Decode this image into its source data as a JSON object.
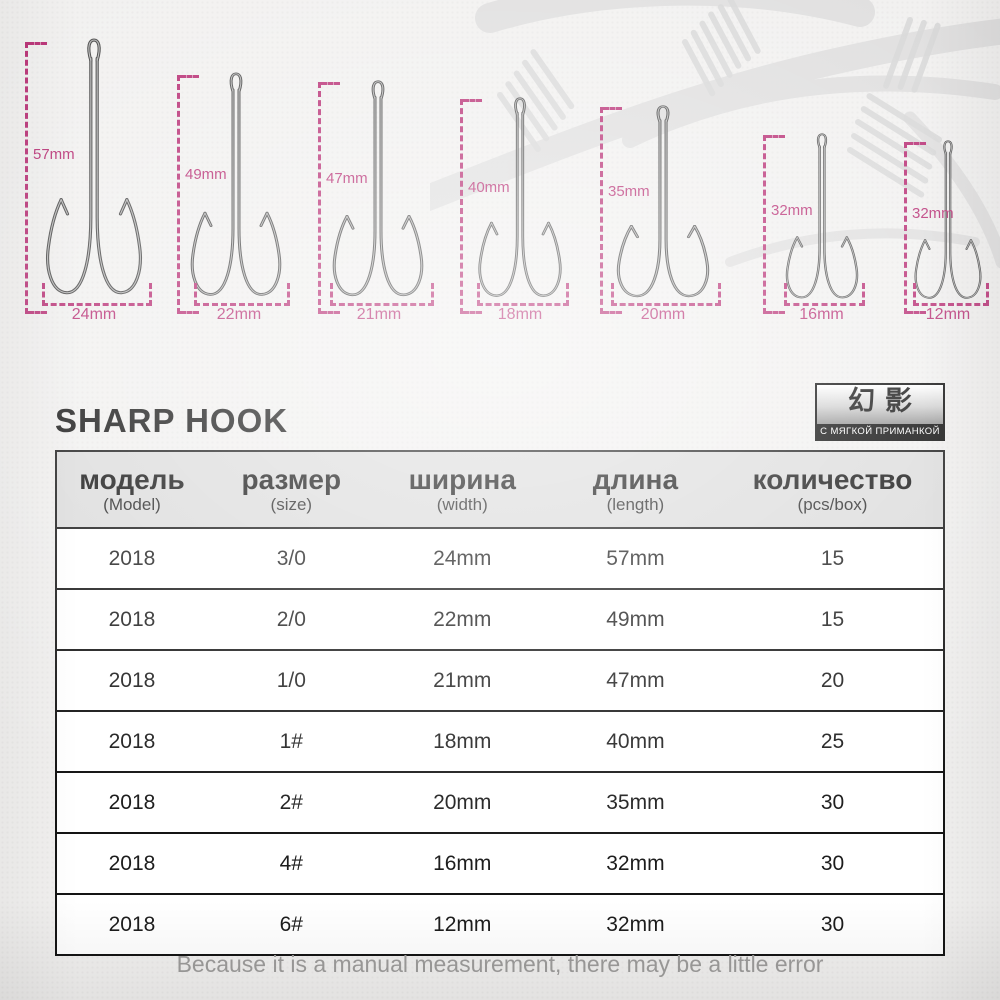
{
  "page": {
    "title": "SHARP HOOK",
    "caption": "Because it is a manual measurement, there may be a little error"
  },
  "logo": {
    "brand": "幻影",
    "subtitle": "С МЯГКОЙ ПРИМАНКОЙ"
  },
  "colors": {
    "accent": "#b5256e",
    "table_border": "#141414",
    "header_bg": "#dbdbdb",
    "caption_text": "#9d9c9b"
  },
  "hooks": [
    {
      "length_label": "57mm",
      "width_label": "24mm"
    },
    {
      "length_label": "49mm",
      "width_label": "22mm"
    },
    {
      "length_label": "47mm",
      "width_label": "21mm"
    },
    {
      "length_label": "40mm",
      "width_label": "18mm"
    },
    {
      "length_label": "35mm",
      "width_label": "20mm"
    },
    {
      "length_label": "32mm",
      "width_label": "16mm"
    },
    {
      "length_label": "32mm",
      "width_label": "12mm"
    }
  ],
  "table": {
    "headers": [
      {
        "label": "модель",
        "sub": "(Model)"
      },
      {
        "label": "размер",
        "sub": "(size)"
      },
      {
        "label": "ширина",
        "sub": "(width)"
      },
      {
        "label": "длина",
        "sub": "(length)"
      },
      {
        "label": "количество",
        "sub": "(pcs/box)"
      }
    ],
    "rows": [
      [
        "2018",
        "3/0",
        "24mm",
        "57mm",
        "15"
      ],
      [
        "2018",
        "2/0",
        "22mm",
        "49mm",
        "15"
      ],
      [
        "2018",
        "1/0",
        "21mm",
        "47mm",
        "20"
      ],
      [
        "2018",
        "1#",
        "18mm",
        "40mm",
        "25"
      ],
      [
        "2018",
        "2#",
        "20mm",
        "35mm",
        "30"
      ],
      [
        "2018",
        "4#",
        "16mm",
        "32mm",
        "30"
      ],
      [
        "2018",
        "6#",
        "12mm",
        "32mm",
        "30"
      ]
    ]
  }
}
